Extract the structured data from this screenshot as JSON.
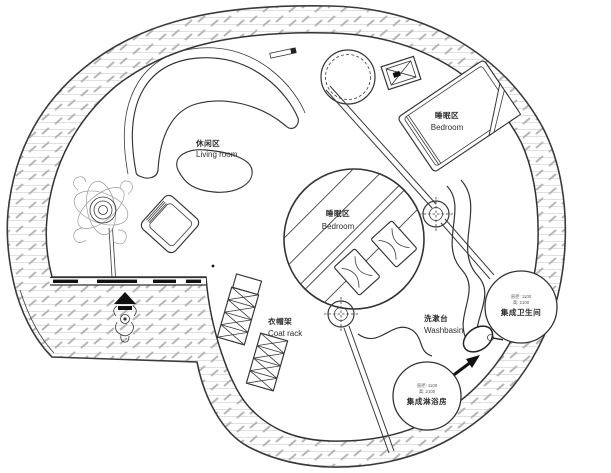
{
  "plan": {
    "type": "circular-house-floor-plan",
    "zones": {
      "living": {
        "zh": "休闲区",
        "en": "Living room"
      },
      "bedroom_main": {
        "zh": "睡眠区",
        "en": "Bedroom"
      },
      "bedroom_center": {
        "zh": "睡眠区",
        "en": "Bedroom"
      },
      "coat_rack": {
        "zh": "衣帽架",
        "en": "Coat rack"
      },
      "washbasin": {
        "zh": "洗漱台",
        "en": "Washbasin"
      },
      "bathroom_pod": {
        "name": "集成卫生间",
        "dims": [
          "直径: 1100",
          "高: 2100"
        ]
      },
      "shower_pod": {
        "name": "集成淋浴房",
        "dims": [
          "直径: 1100",
          "高: 2100"
        ]
      }
    },
    "symbols": [
      "column-marker",
      "skylight",
      "vent-box",
      "entry-person",
      "entry-arrow",
      "direction-arrow"
    ],
    "colors": {
      "line": "#333333",
      "hatch_line": "#d6d6d6",
      "hatch_dash": "#b5b5b5",
      "accent_black": "#111111",
      "background": "#ffffff"
    }
  }
}
